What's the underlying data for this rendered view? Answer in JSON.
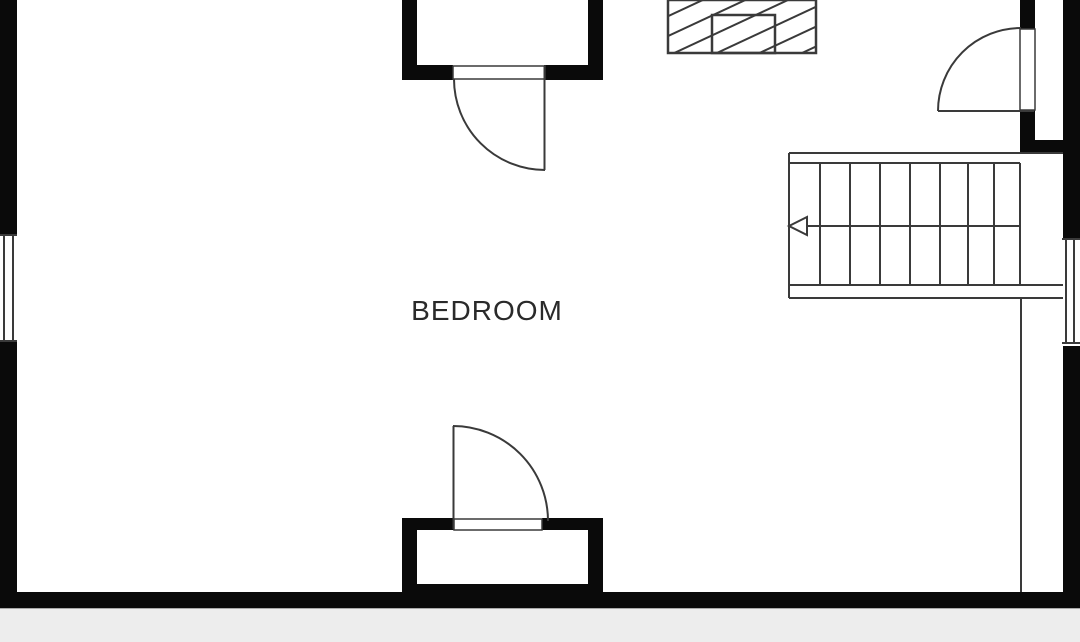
{
  "floor_plan": {
    "room_label": "BEDROOM",
    "colors": {
      "wall": "#0a0a0a",
      "line": "#3a3a3a",
      "background": "#ffffff",
      "floor_strip": "#ededed"
    },
    "stairs": {
      "tread_columns": 8,
      "direction_arrow": "left"
    },
    "elements": {
      "windows": [
        "left-wall-window",
        "right-wall-window"
      ],
      "doors": [
        "top-closet-door",
        "bottom-closet-door",
        "entry-door"
      ],
      "chimney": "hatched-rectangle",
      "closets": [
        "top-closet",
        "bottom-closet"
      ]
    }
  }
}
